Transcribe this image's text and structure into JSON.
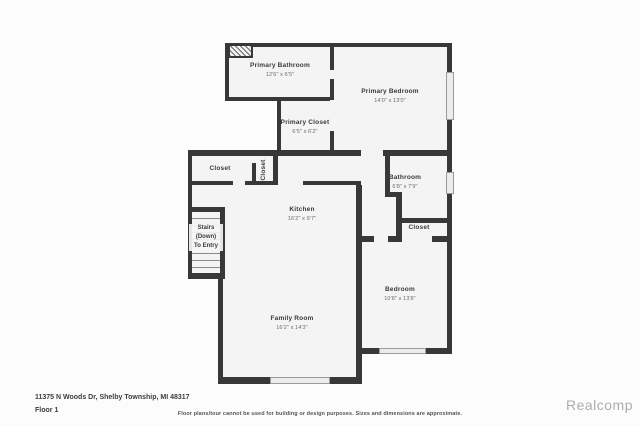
{
  "floorplan": {
    "rooms": {
      "primary_bathroom": {
        "name": "Primary Bathroom",
        "dims": "12'6\" x 6'5\""
      },
      "primary_bedroom": {
        "name": "Primary Bedroom",
        "dims": "14'0\" x 13'0\""
      },
      "primary_closet": {
        "name": "Primary Closet",
        "dims": "6'5\" x 6'2\""
      },
      "closet_hall": {
        "name": "Closet"
      },
      "closet_vertical": {
        "name": "Closet"
      },
      "kitchen": {
        "name": "Kitchen",
        "dims": "16'2\" x 9'7\""
      },
      "bathroom": {
        "name": "Bathroom",
        "dims": "6'8\" x 7'9\""
      },
      "closet_bedroom": {
        "name": "Closet"
      },
      "bedroom": {
        "name": "Bedroom",
        "dims": "10'8\" x 13'8\""
      },
      "family_room": {
        "name": "Family Room",
        "dims": "16'2\" x 14'3\""
      },
      "stairs": {
        "line1": "Stairs",
        "line2": "(Down)",
        "line3": "To Entry"
      }
    },
    "colors": {
      "wall": "#383838",
      "floor": "#f4f4f4",
      "window": "#ececec"
    }
  },
  "footer": {
    "address": "11375 N Woods Dr, Shelby Township, MI 48317",
    "floor_label": "Floor 1",
    "disclaimer": "Floor plans/tour cannot be used for building or design purposes. Sizes and dimensions are approximate.",
    "brand": "Realcomp"
  }
}
